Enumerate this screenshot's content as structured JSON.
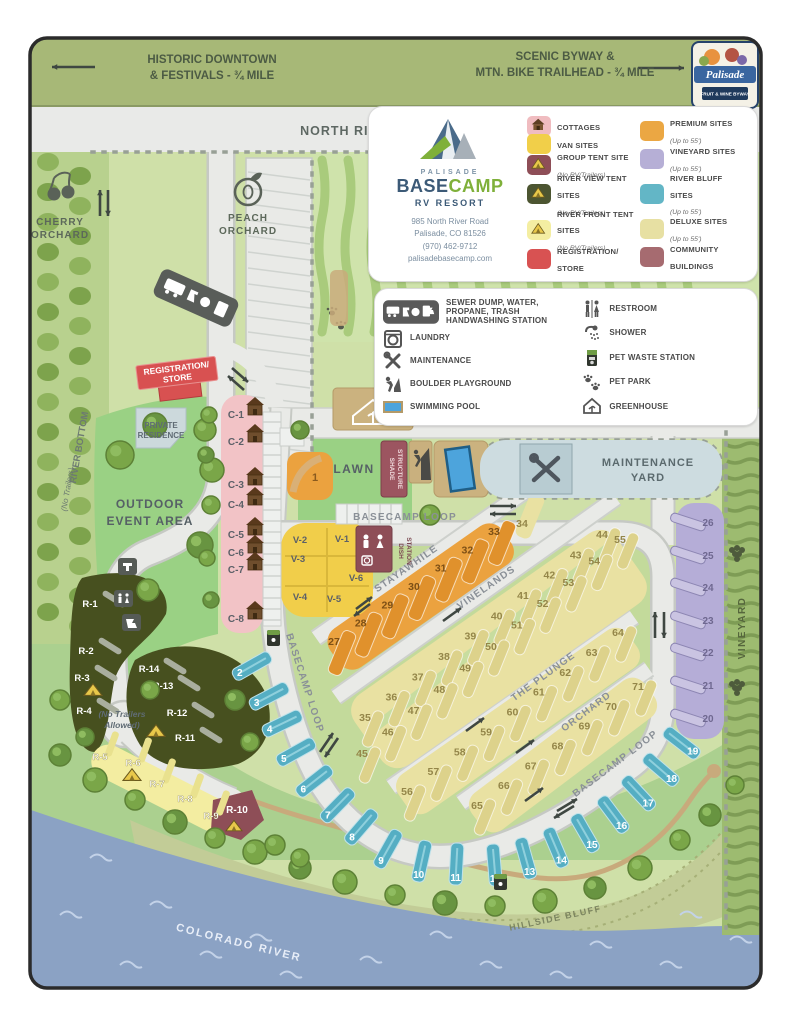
{
  "banner": {
    "left1": "HISTORIC DOWNTOWN",
    "left2": "& FESTIVALS - ¾ MILE",
    "right1": "SCENIC BYWAY &",
    "right2": "MTN. BIKE TRAILHEAD - ¾ MILE"
  },
  "byway_badge": {
    "name": "Palisade",
    "sub": "FRUIT & WINE BYWAY"
  },
  "road_label": "NORTH RIVER ROAD & BIKE PATH",
  "brand": {
    "palisade": "PALISADE",
    "base": "BASE",
    "camp": "CAMP",
    "sub": "RV RESORT",
    "addr1": "985 North River Road",
    "addr2": "Palisade, CO 81526",
    "phone": "(970) 462-9712",
    "web": "palisadebasecamp.com"
  },
  "legend_sites_left": [
    {
      "label": "COTTAGES",
      "note": "",
      "swatch": "#f0bcc0",
      "icon": "cabin-icon"
    },
    {
      "label": "VAN SITES",
      "note": "",
      "swatch": "#f1cf49",
      "icon": ""
    },
    {
      "label": "GROUP TENT SITE",
      "note": "(No RV/Trailers)",
      "swatch": "#8e4e57",
      "icon": "tent-icon"
    },
    {
      "label": "RIVER VIEW TENT SITES",
      "note": "(No RV/Trailers)",
      "swatch": "#4c5531",
      "icon": "tent-icon"
    },
    {
      "label": "RIVER FRONT TENT SITES",
      "note": "(No RV/Trailers)",
      "swatch": "#f4eea2",
      "icon": "tent-icon"
    },
    {
      "label": "REGISTRATION/ STORE",
      "note": "",
      "swatch": "#d85252",
      "icon": ""
    }
  ],
  "legend_sites_right": [
    {
      "label": "PREMIUM SITES",
      "note": "(Up to 55')",
      "swatch": "#eba743"
    },
    {
      "label": "VINEYARD SITES",
      "note": "(Up to 55')",
      "swatch": "#b6afd6"
    },
    {
      "label": "RIVER BLUFF SITES",
      "note": "(Up to 55')",
      "swatch": "#63b6c6"
    },
    {
      "label": "DELUXE SITES",
      "note": "(Up to 55')",
      "swatch": "#e7e0a3"
    },
    {
      "label": "COMMUNITY BUILDINGS",
      "note": "",
      "swatch": "#a66b70"
    }
  ],
  "legend_amenities_left": [
    {
      "label": "SEWER DUMP, WATER, PROPANE, TRASH HANDWASHING STATION",
      "icon": "dump-station-icons"
    },
    {
      "label": "LAUNDRY",
      "icon": "laundry-icon"
    },
    {
      "label": "MAINTENANCE",
      "icon": "maintenance-icon"
    },
    {
      "label": "BOULDER PLAYGROUND",
      "icon": "boulder-playground-icon"
    },
    {
      "label": "SWIMMING POOL",
      "icon": "swimming-pool-icon"
    }
  ],
  "legend_amenities_right": [
    {
      "label": "RESTROOM",
      "icon": "restroom-icon"
    },
    {
      "label": "SHOWER",
      "icon": "shower-icon"
    },
    {
      "label": "PET WASTE STATION",
      "icon": "pet-waste-icon"
    },
    {
      "label": "PET PARK",
      "icon": "pet-park-icon"
    },
    {
      "label": "GREENHOUSE",
      "icon": "greenhouse-icon"
    }
  ],
  "areas": {
    "cherry1": "CHERRY",
    "cherry2": "ORCHARD",
    "peach1": "PEACH",
    "peach2": "ORCHARD",
    "registration1": "REGISTRATION/",
    "registration2": "STORE",
    "private1": "PRIVATE",
    "private2": "RESIDENCE",
    "event1": "OUTDOOR",
    "event2": "EVENT AREA",
    "river_bottom": "RIVER BOTTOM",
    "no_trailers": "(No Trailers)",
    "lawn": "LAWN",
    "shade1": "SHADE",
    "shade2": "STRUCTURE",
    "maint1": "MAINTENANCE",
    "maint2": "YARD",
    "basecamp_loop": "BASECAMP LOOP",
    "stayawhile": "STAYAWHILE",
    "vinelands": "VINELANDS",
    "plunge": "THE PLUNGE",
    "orchard_rd": "ORCHARD",
    "vineyard": "VINEYARD",
    "dish1": "DISH",
    "dish2": "STATION",
    "nta1": "(No Trailers",
    "nta2": "Allowed)",
    "hillside": "HILLSIDE BLUFF",
    "river": "COLORADO RIVER"
  },
  "sites": {
    "premium_single": "1",
    "stayawhile": [
      "27",
      "28",
      "29",
      "30",
      "31",
      "32",
      "33"
    ],
    "site_34": "34",
    "vinelands_upper": [
      "35",
      "36",
      "37",
      "38",
      "39",
      "40",
      "41",
      "42",
      "43",
      "44"
    ],
    "vinelands_lower": [
      "45",
      "46",
      "47",
      "48",
      "49",
      "50",
      "51",
      "52",
      "53",
      "54",
      "55"
    ],
    "plunge": [
      "56",
      "57",
      "58",
      "59",
      "60",
      "61",
      "62",
      "63",
      "64"
    ],
    "orchard": [
      "65",
      "66",
      "67",
      "68",
      "69",
      "70",
      "71"
    ],
    "river_bluff": [
      "2",
      "3",
      "4",
      "5",
      "6",
      "7",
      "8",
      "9",
      "10",
      "11",
      "12",
      "13",
      "14",
      "15",
      "16",
      "17",
      "18",
      "19"
    ],
    "vineyard": [
      "26",
      "25",
      "24",
      "23",
      "22",
      "21",
      "20"
    ],
    "cottages": [
      "C-1",
      "C-2",
      "C-3",
      "C-4",
      "C-5",
      "C-6",
      "C-7",
      "C-8"
    ],
    "van": [
      "V-2",
      "V-1",
      "V-3",
      "V-6",
      "V-4",
      "V-5"
    ],
    "river_view_left": [
      "R-1",
      "R-2",
      "R-3",
      "R-4"
    ],
    "river_view_right": [
      "R-14",
      "R-13",
      "R-12",
      "R-11"
    ],
    "river_front": [
      "R-5",
      "R-6",
      "R-7",
      "R-8",
      "R-9"
    ],
    "group_tent": "R-10"
  },
  "colors": {
    "premium": "#eba23f",
    "premium_pad": "#e0912c",
    "deluxe": "#e9e1a2",
    "deluxe_pad": "#ddd28b",
    "river_bluff": "#5fb4c9",
    "river_bluff_pad": "#55aec3",
    "vineyard": "#b5add7",
    "vineyard_pad": "#cac4e2",
    "cottage": "#f2c3c6",
    "van": "#f1ce4a",
    "group_tent": "#8e4e57",
    "river_view": "#47501f",
    "river_front": "#f3eda1",
    "registration": "#d85151",
    "community": "#a66b70",
    "road": "#e9eae7",
    "road_edge": "#c6c9c4"
  }
}
